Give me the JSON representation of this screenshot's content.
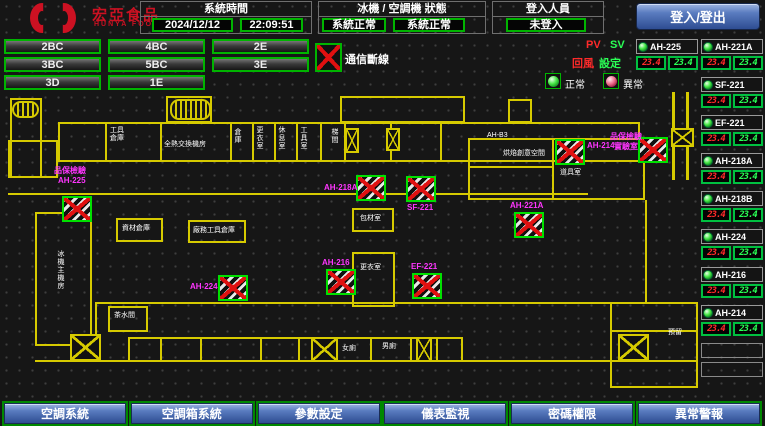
{
  "header": {
    "brand": "宏亞食品",
    "brand_en": "HUNYA FOODS",
    "system_time": {
      "label": "系統時間",
      "date": "2024/12/12",
      "time": "22:09:51"
    },
    "machine_status": {
      "label": "冰機 / 空調機 狀態",
      "chiller": "系統正常",
      "ahu": "系統正常"
    },
    "login": {
      "label": "登入人員",
      "value": "未登入",
      "button": "登入/登出"
    }
  },
  "floor_buttons": [
    "2BC",
    "4BC",
    "2E",
    "3BC",
    "5BC",
    "3E",
    "3D",
    "1E"
  ],
  "legend": {
    "comm_fail": "通信斷線",
    "pv": "PV",
    "sv": "SV",
    "pv_name": "回風",
    "sv_name": "設定",
    "normal": "正常",
    "abnormal": "異常",
    "pv_color": "#ff2a2a",
    "sv_color": "#2aff55"
  },
  "units": {
    "left_column": [
      {
        "name": "AH-225",
        "pv": "23.4",
        "sv": "23.4"
      }
    ],
    "right_column": [
      {
        "name": "AH-221A",
        "pv": "23.4",
        "sv": "23.4"
      },
      {
        "name": "SF-221",
        "pv": "23.4",
        "sv": "23.4"
      },
      {
        "name": "EF-221",
        "pv": "23.4",
        "sv": "23.4"
      },
      {
        "name": "AH-218A",
        "pv": "23.4",
        "sv": "23.4"
      },
      {
        "name": "AH-218B",
        "pv": "23.4",
        "sv": "23.4"
      },
      {
        "name": "AH-224",
        "pv": "23.4",
        "sv": "23.4"
      },
      {
        "name": "AH-216",
        "pv": "23.4",
        "sv": "23.4"
      },
      {
        "name": "AH-214",
        "pv": "23.4",
        "sv": "23.4"
      }
    ],
    "empty_slots": 2
  },
  "map": {
    "wall_color": "#d6ca00",
    "walls_rect": [
      [
        58,
        122,
        582,
        40
      ],
      [
        340,
        96,
        125,
        27
      ],
      [
        508,
        99,
        24,
        24
      ],
      [
        166,
        96,
        46,
        27
      ],
      [
        10,
        98,
        32,
        80
      ],
      [
        8,
        140,
        50,
        38
      ],
      [
        35,
        212,
        57,
        134
      ],
      [
        116,
        218,
        47,
        24
      ],
      [
        188,
        220,
        58,
        23
      ],
      [
        352,
        208,
        42,
        24
      ],
      [
        352,
        252,
        43,
        55
      ],
      [
        468,
        138,
        177,
        62
      ],
      [
        108,
        306,
        40,
        26
      ],
      [
        610,
        302,
        88,
        86
      ],
      [
        128,
        337,
        335,
        25
      ]
    ],
    "walls_fill": [
      [
        105,
        122,
        2,
        40
      ],
      [
        160,
        122,
        2,
        40
      ],
      [
        230,
        122,
        2,
        40
      ],
      [
        252,
        122,
        2,
        40
      ],
      [
        274,
        122,
        2,
        40
      ],
      [
        296,
        122,
        2,
        40
      ],
      [
        320,
        122,
        2,
        40
      ],
      [
        344,
        122,
        2,
        40
      ],
      [
        390,
        122,
        2,
        40
      ],
      [
        440,
        122,
        2,
        40
      ],
      [
        552,
        138,
        2,
        62
      ],
      [
        645,
        200,
        2,
        102
      ],
      [
        672,
        92,
        3,
        88
      ],
      [
        686,
        92,
        3,
        88
      ],
      [
        8,
        193,
        580,
        2
      ],
      [
        468,
        166,
        86,
        2
      ],
      [
        95,
        302,
        550,
        2
      ],
      [
        95,
        302,
        2,
        60
      ],
      [
        35,
        360,
        663,
        2
      ],
      [
        610,
        330,
        88,
        2
      ],
      [
        160,
        337,
        2,
        25
      ],
      [
        200,
        337,
        2,
        25
      ],
      [
        260,
        337,
        2,
        25
      ],
      [
        298,
        337,
        2,
        25
      ],
      [
        370,
        337,
        2,
        25
      ],
      [
        410,
        337,
        2,
        25
      ],
      [
        436,
        337,
        2,
        25
      ]
    ],
    "labels": [
      {
        "text": "工具\n倉庫",
        "x": 110,
        "y": 127,
        "c": "w"
      },
      {
        "text": "全熱交換機房",
        "x": 164,
        "y": 141,
        "c": "w"
      },
      {
        "text": "資材倉庫",
        "x": 122,
        "y": 225,
        "c": "w"
      },
      {
        "text": "廠務工具倉庫",
        "x": 193,
        "y": 227,
        "c": "w"
      },
      {
        "text": "冰機主機房",
        "x": 56,
        "y": 250,
        "c": "v"
      },
      {
        "text": "包材室",
        "x": 360,
        "y": 215,
        "c": "w"
      },
      {
        "text": "更衣室",
        "x": 360,
        "y": 264,
        "c": "w"
      },
      {
        "text": "女廁",
        "x": 342,
        "y": 345,
        "c": "w"
      },
      {
        "text": "男廁",
        "x": 382,
        "y": 343,
        "c": "w"
      },
      {
        "text": "茶水間",
        "x": 114,
        "y": 312,
        "c": "w"
      },
      {
        "text": "AH-B3",
        "x": 487,
        "y": 132,
        "c": "w"
      },
      {
        "text": "烘焙創意空間",
        "x": 503,
        "y": 150,
        "c": "w"
      },
      {
        "text": "道具室",
        "x": 560,
        "y": 169,
        "c": "w"
      },
      {
        "text": "預留",
        "x": 668,
        "y": 329,
        "c": "w"
      },
      {
        "text": "倉庫",
        "x": 233,
        "y": 128,
        "c": "v"
      },
      {
        "text": "更衣室",
        "x": 255,
        "y": 126,
        "c": "v"
      },
      {
        "text": "休息室",
        "x": 277,
        "y": 126,
        "c": "v"
      },
      {
        "text": "工具室",
        "x": 299,
        "y": 126,
        "c": "v"
      },
      {
        "text": "梯間",
        "x": 330,
        "y": 128,
        "c": "v"
      },
      {
        "text": "品保檢驗",
        "x": 54,
        "y": 167,
        "c": "m"
      },
      {
        "text": "AH-225",
        "x": 58,
        "y": 177,
        "c": "m"
      },
      {
        "text": "AH-224",
        "x": 190,
        "y": 283,
        "c": "m"
      },
      {
        "text": "AH-218A",
        "x": 324,
        "y": 184,
        "c": "m"
      },
      {
        "text": "SF-221",
        "x": 407,
        "y": 204,
        "c": "m"
      },
      {
        "text": "AH-216",
        "x": 322,
        "y": 259,
        "c": "m"
      },
      {
        "text": "EF-221",
        "x": 411,
        "y": 263,
        "c": "m"
      },
      {
        "text": "AH-214",
        "x": 587,
        "y": 142,
        "c": "m"
      },
      {
        "text": "品保檢驗",
        "x": 610,
        "y": 133,
        "c": "m"
      },
      {
        "text": "實驗室",
        "x": 614,
        "y": 143,
        "c": "m"
      },
      {
        "text": "AH-221A",
        "x": 510,
        "y": 202,
        "c": "m"
      }
    ],
    "equipment": [
      {
        "unit": "AH-225",
        "x": 62,
        "y": 196
      },
      {
        "unit": "AH-224",
        "x": 218,
        "y": 275
      },
      {
        "unit": "AH-218A",
        "x": 356,
        "y": 175
      },
      {
        "unit": "SF-221",
        "x": 406,
        "y": 176
      },
      {
        "unit": "AH-216",
        "x": 326,
        "y": 269
      },
      {
        "unit": "EF-221",
        "x": 412,
        "y": 273
      },
      {
        "unit": "AH-214",
        "x": 555,
        "y": 139
      },
      {
        "unit": "AH-218B",
        "x": 638,
        "y": 137
      },
      {
        "unit": "AH-221A",
        "x": 514,
        "y": 212
      }
    ],
    "shafts": [
      [
        345,
        128,
        14,
        25
      ],
      [
        386,
        128,
        14,
        23
      ],
      [
        671,
        128,
        23,
        19
      ],
      [
        70,
        334,
        31,
        27
      ],
      [
        311,
        337,
        27,
        25
      ],
      [
        416,
        337,
        16,
        25
      ],
      [
        618,
        334,
        31,
        27
      ]
    ],
    "stairs": [
      [
        170,
        99,
        41,
        21
      ],
      [
        12,
        101,
        27,
        17
      ]
    ]
  },
  "footer": {
    "buttons": [
      "空調系統",
      "空調箱系統",
      "參數設定",
      "儀表監視",
      "密碼權限",
      "異常警報"
    ]
  }
}
